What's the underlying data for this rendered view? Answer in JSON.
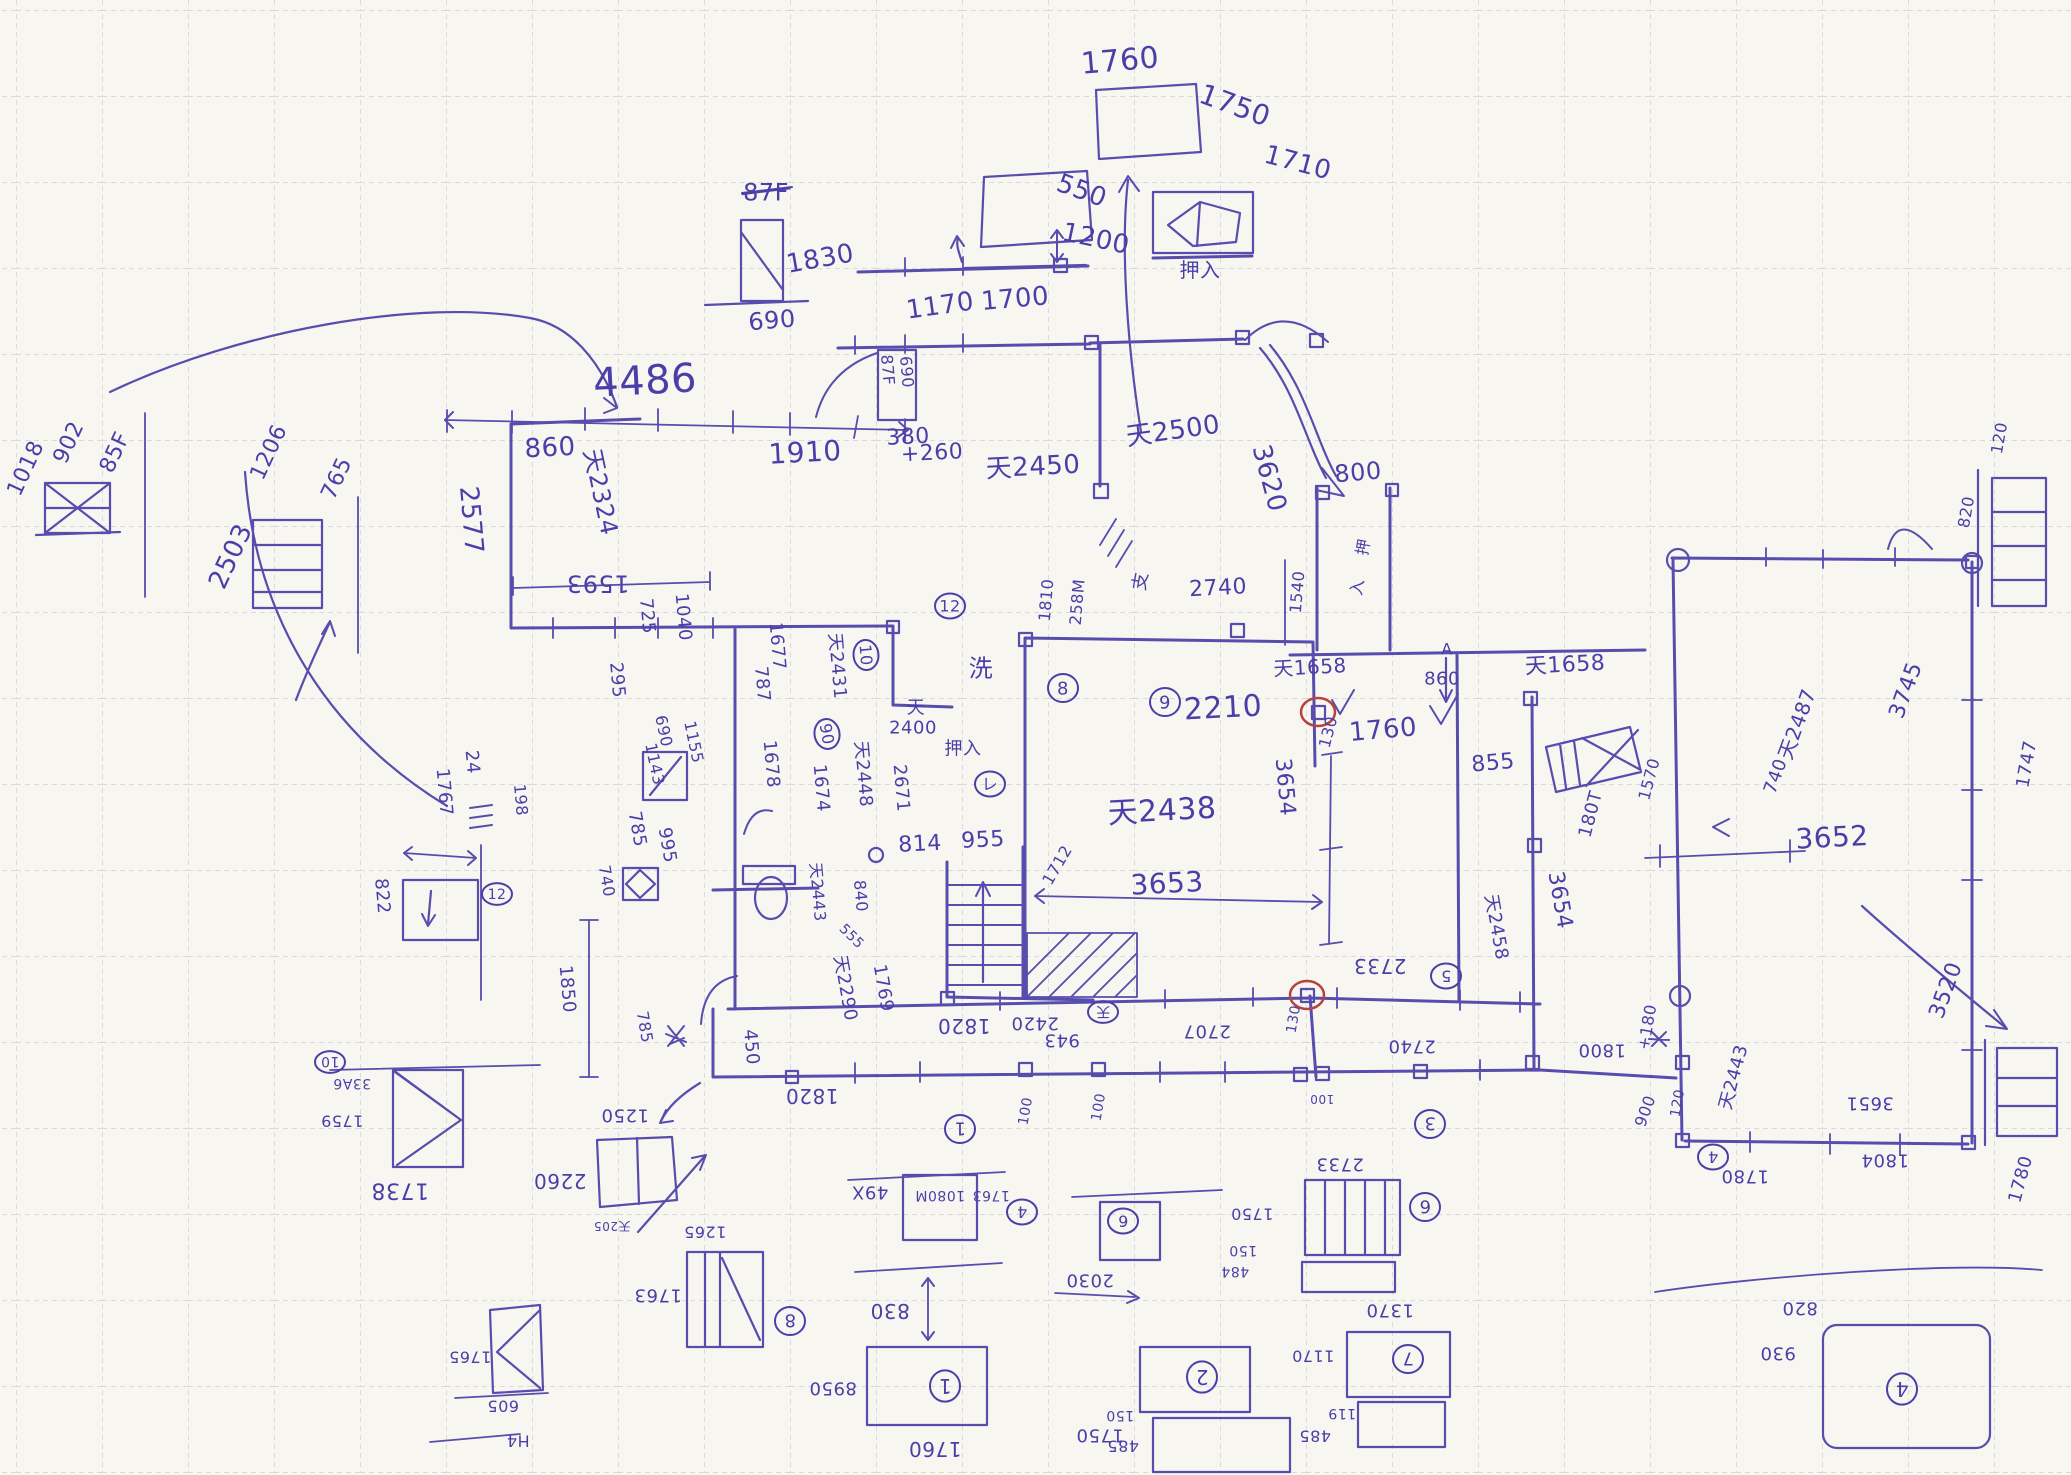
{
  "colors": {
    "paper": "#f8f6f1",
    "grid": "#c6c8d3",
    "primary": "#4a3fa8",
    "red": "#b5443c"
  },
  "annotations": [
    {
      "t": "1760",
      "x": 1120,
      "y": 60,
      "r": -5,
      "s": 30
    },
    {
      "t": "1750",
      "x": 1235,
      "y": 105,
      "r": 20,
      "s": 28
    },
    {
      "t": "550",
      "x": 1082,
      "y": 190,
      "r": 20,
      "s": 26
    },
    {
      "t": "1200",
      "x": 1096,
      "y": 238,
      "r": 12,
      "s": 26
    },
    {
      "t": "1170",
      "x": 940,
      "y": 305,
      "r": -8,
      "s": 26
    },
    {
      "t": "1700",
      "x": 1015,
      "y": 298,
      "r": -5,
      "s": 26
    },
    {
      "t": "87F",
      "x": 766,
      "y": 192,
      "r": 0,
      "s": 24,
      "strike": true
    },
    {
      "t": "1830",
      "x": 820,
      "y": 258,
      "r": -10,
      "s": 26
    },
    {
      "t": "690",
      "x": 772,
      "y": 320,
      "r": -5,
      "s": 24
    },
    {
      "t": "1710",
      "x": 1298,
      "y": 162,
      "r": 15,
      "s": 26
    },
    {
      "t": "押入",
      "x": 1200,
      "y": 270,
      "r": 0,
      "s": 20
    },
    {
      "t": "4486",
      "x": 645,
      "y": 380,
      "r": -3,
      "s": 40
    },
    {
      "t": "860",
      "x": 550,
      "y": 447,
      "r": -3,
      "s": 26
    },
    {
      "t": "1910",
      "x": 805,
      "y": 452,
      "r": -3,
      "s": 28
    },
    {
      "t": "380",
      "x": 908,
      "y": 436,
      "r": -3,
      "s": 22
    },
    {
      "t": "+260",
      "x": 932,
      "y": 452,
      "r": -3,
      "s": 22
    },
    {
      "t": "87F",
      "x": 888,
      "y": 370,
      "r": 85,
      "s": 16
    },
    {
      "t": "690",
      "x": 907,
      "y": 372,
      "r": 85,
      "s": 16
    },
    {
      "t": "天2500",
      "x": 1173,
      "y": 430,
      "r": -8,
      "s": 26
    },
    {
      "t": "天2450",
      "x": 1033,
      "y": 466,
      "r": -3,
      "s": 26
    },
    {
      "t": "3620",
      "x": 1270,
      "y": 478,
      "r": 75,
      "s": 26
    },
    {
      "t": "800",
      "x": 1358,
      "y": 472,
      "r": -5,
      "s": 24
    },
    {
      "t": "902",
      "x": 68,
      "y": 442,
      "r": -65,
      "s": 22
    },
    {
      "t": "85F",
      "x": 114,
      "y": 452,
      "r": -65,
      "s": 22
    },
    {
      "t": "1018",
      "x": 25,
      "y": 468,
      "r": -65,
      "s": 22
    },
    {
      "t": "1206",
      "x": 268,
      "y": 452,
      "r": -65,
      "s": 22
    },
    {
      "t": "765",
      "x": 336,
      "y": 478,
      "r": -65,
      "s": 22
    },
    {
      "t": "2503",
      "x": 230,
      "y": 556,
      "r": -65,
      "s": 26
    },
    {
      "t": "2577",
      "x": 472,
      "y": 520,
      "r": 85,
      "s": 26
    },
    {
      "t": "天2324",
      "x": 601,
      "y": 492,
      "r": 78,
      "s": 24
    },
    {
      "t": "1593",
      "x": 598,
      "y": 584,
      "r": 180,
      "s": 24
    },
    {
      "t": "725",
      "x": 648,
      "y": 616,
      "r": 85,
      "s": 18
    },
    {
      "t": "1040",
      "x": 684,
      "y": 617,
      "r": 85,
      "s": 18
    },
    {
      "t": "295",
      "x": 618,
      "y": 680,
      "r": 85,
      "s": 18
    },
    {
      "t": "1677",
      "x": 778,
      "y": 646,
      "r": 85,
      "s": 18
    },
    {
      "t": "787",
      "x": 763,
      "y": 684,
      "r": 85,
      "s": 18
    },
    {
      "t": "天2431",
      "x": 838,
      "y": 666,
      "r": 85,
      "s": 18
    },
    {
      "t": "10",
      "x": 866,
      "y": 655,
      "r": 85,
      "s": 16,
      "circ": true
    },
    {
      "t": "12",
      "x": 950,
      "y": 606,
      "r": 0,
      "s": 16,
      "circ": true
    },
    {
      "t": "洗",
      "x": 981,
      "y": 668,
      "r": 0,
      "s": 24
    },
    {
      "t": "天",
      "x": 916,
      "y": 707,
      "r": 0,
      "s": 18
    },
    {
      "t": "2400",
      "x": 913,
      "y": 727,
      "r": 0,
      "s": 18
    },
    {
      "t": "押入",
      "x": 963,
      "y": 748,
      "r": 0,
      "s": 18
    },
    {
      "t": "レ",
      "x": 990,
      "y": 784,
      "r": 0,
      "s": 16,
      "circ": true
    },
    {
      "t": "690",
      "x": 664,
      "y": 731,
      "r": 78,
      "s": 16
    },
    {
      "t": "1143",
      "x": 655,
      "y": 764,
      "r": 78,
      "s": 16
    },
    {
      "t": "1155",
      "x": 694,
      "y": 742,
      "r": 78,
      "s": 16
    },
    {
      "t": "1678",
      "x": 772,
      "y": 764,
      "r": 85,
      "s": 18
    },
    {
      "t": "1674",
      "x": 822,
      "y": 788,
      "r": 85,
      "s": 18
    },
    {
      "t": "天2448",
      "x": 864,
      "y": 774,
      "r": 85,
      "s": 18
    },
    {
      "t": "2671",
      "x": 902,
      "y": 788,
      "r": 85,
      "s": 18
    },
    {
      "t": "90",
      "x": 827,
      "y": 734,
      "r": 80,
      "s": 16,
      "circ": true
    },
    {
      "t": "995",
      "x": 668,
      "y": 845,
      "r": 80,
      "s": 18
    },
    {
      "t": "785",
      "x": 638,
      "y": 829,
      "r": 80,
      "s": 18
    },
    {
      "t": "740",
      "x": 607,
      "y": 881,
      "r": 80,
      "s": 16
    },
    {
      "t": "814",
      "x": 920,
      "y": 843,
      "r": -3,
      "s": 22
    },
    {
      "t": "955",
      "x": 983,
      "y": 839,
      "r": -3,
      "s": 22
    },
    {
      "t": "天2443",
      "x": 818,
      "y": 892,
      "r": 85,
      "s": 16
    },
    {
      "t": "840",
      "x": 861,
      "y": 896,
      "r": 85,
      "s": 16
    },
    {
      "t": "555",
      "x": 852,
      "y": 936,
      "r": 45,
      "s": 14
    },
    {
      "t": "天2290",
      "x": 846,
      "y": 988,
      "r": 80,
      "s": 18
    },
    {
      "t": "1769",
      "x": 884,
      "y": 988,
      "r": 80,
      "s": 18
    },
    {
      "t": "450",
      "x": 752,
      "y": 1047,
      "r": 85,
      "s": 18
    },
    {
      "t": "198",
      "x": 521,
      "y": 800,
      "r": 85,
      "s": 16
    },
    {
      "t": "1712",
      "x": 1057,
      "y": 865,
      "r": -60,
      "s": 16
    },
    {
      "t": "8",
      "x": 1063,
      "y": 688,
      "r": 0,
      "s": 18,
      "circ": true
    },
    {
      "t": "9",
      "x": 1165,
      "y": 702,
      "r": 0,
      "s": 18,
      "circ": true
    },
    {
      "t": "2210",
      "x": 1223,
      "y": 707,
      "r": -3,
      "s": 30
    },
    {
      "t": "130",
      "x": 1328,
      "y": 732,
      "r": -75,
      "s": 16
    },
    {
      "t": "1760",
      "x": 1383,
      "y": 729,
      "r": -5,
      "s": 26
    },
    {
      "t": "天1658",
      "x": 1310,
      "y": 667,
      "r": -3,
      "s": 20
    },
    {
      "t": "天1658",
      "x": 1565,
      "y": 664,
      "r": -3,
      "s": 22
    },
    {
      "t": "A",
      "x": 1447,
      "y": 649,
      "r": 0,
      "s": 16
    },
    {
      "t": "860",
      "x": 1442,
      "y": 678,
      "r": 0,
      "s": 18
    },
    {
      "t": "855",
      "x": 1493,
      "y": 762,
      "r": -5,
      "s": 22
    },
    {
      "t": "天2438",
      "x": 1162,
      "y": 810,
      "r": -3,
      "s": 30
    },
    {
      "t": "3654",
      "x": 1286,
      "y": 787,
      "r": 85,
      "s": 22
    },
    {
      "t": "3653",
      "x": 1167,
      "y": 883,
      "r": -3,
      "s": 28
    },
    {
      "t": "180T",
      "x": 1590,
      "y": 814,
      "r": -75,
      "s": 18
    },
    {
      "t": "1570",
      "x": 1649,
      "y": 779,
      "r": -75,
      "s": 16
    },
    {
      "t": "3654",
      "x": 1561,
      "y": 900,
      "r": 80,
      "s": 22
    },
    {
      "t": "天2458",
      "x": 1497,
      "y": 927,
      "r": 80,
      "s": 18
    },
    {
      "t": "天2487",
      "x": 1797,
      "y": 724,
      "r": -70,
      "s": 20
    },
    {
      "t": "740",
      "x": 1775,
      "y": 776,
      "r": -70,
      "s": 18
    },
    {
      "t": "3745",
      "x": 1905,
      "y": 690,
      "r": -70,
      "s": 22
    },
    {
      "t": "1747",
      "x": 2026,
      "y": 764,
      "r": -80,
      "s": 18
    },
    {
      "t": "3652",
      "x": 1832,
      "y": 837,
      "r": -3,
      "s": 28
    },
    {
      "t": "3520",
      "x": 1945,
      "y": 990,
      "r": -70,
      "s": 22
    },
    {
      "t": "120",
      "x": 1999,
      "y": 438,
      "r": -80,
      "s": 16
    },
    {
      "t": "820",
      "x": 1966,
      "y": 512,
      "r": -80,
      "s": 16
    },
    {
      "t": "1810",
      "x": 1046,
      "y": 600,
      "r": -85,
      "s": 16
    },
    {
      "t": "258M",
      "x": 1077,
      "y": 602,
      "r": -85,
      "s": 16
    },
    {
      "t": "支",
      "x": 1140,
      "y": 581,
      "r": -80,
      "s": 18
    },
    {
      "t": "2740",
      "x": 1218,
      "y": 587,
      "r": -3,
      "s": 22
    },
    {
      "t": "1540",
      "x": 1297,
      "y": 592,
      "r": -85,
      "s": 16
    },
    {
      "t": "押",
      "x": 1363,
      "y": 547,
      "r": -80,
      "s": 16
    },
    {
      "t": "入",
      "x": 1357,
      "y": 587,
      "r": -80,
      "s": 16
    },
    {
      "t": "1850",
      "x": 568,
      "y": 989,
      "r": 85,
      "s": 18
    },
    {
      "t": "785",
      "x": 645,
      "y": 1027,
      "r": 80,
      "s": 16
    },
    {
      "t": "1820",
      "x": 964,
      "y": 1026,
      "r": 180,
      "s": 20
    },
    {
      "t": "2420",
      "x": 1035,
      "y": 1024,
      "r": 180,
      "s": 18
    },
    {
      "t": "天",
      "x": 1103,
      "y": 1012,
      "r": 180,
      "s": 14,
      "circ": true
    },
    {
      "t": "943",
      "x": 1062,
      "y": 1041,
      "r": 180,
      "s": 18
    },
    {
      "t": "2707",
      "x": 1207,
      "y": 1032,
      "r": 180,
      "s": 18
    },
    {
      "t": "130",
      "x": 1293,
      "y": 1019,
      "r": -80,
      "s": 14
    },
    {
      "t": "2733",
      "x": 1380,
      "y": 966,
      "r": 180,
      "s": 20
    },
    {
      "t": "5",
      "x": 1446,
      "y": 976,
      "r": 180,
      "s": 16,
      "circ": true
    },
    {
      "t": "2740",
      "x": 1412,
      "y": 1047,
      "r": 180,
      "s": 18
    },
    {
      "t": "100",
      "x": 1025,
      "y": 1111,
      "r": -80,
      "s": 14
    },
    {
      "t": "100",
      "x": 1098,
      "y": 1107,
      "r": -80,
      "s": 14
    },
    {
      "t": "100",
      "x": 1322,
      "y": 1099,
      "r": 180,
      "s": 12
    },
    {
      "t": "1",
      "x": 960,
      "y": 1129,
      "r": 180,
      "s": 18,
      "circ": true
    },
    {
      "t": "3",
      "x": 1430,
      "y": 1124,
      "r": 180,
      "s": 18,
      "circ": true
    },
    {
      "t": "1820",
      "x": 812,
      "y": 1096,
      "r": 180,
      "s": 20
    },
    {
      "t": "1250",
      "x": 625,
      "y": 1116,
      "r": 180,
      "s": 18
    },
    {
      "t": "2260",
      "x": 560,
      "y": 1181,
      "r": 180,
      "s": 20
    },
    {
      "t": "天205",
      "x": 612,
      "y": 1226,
      "r": 180,
      "s": 12
    },
    {
      "t": "1265",
      "x": 705,
      "y": 1232,
      "r": 180,
      "s": 16
    },
    {
      "t": "1763",
      "x": 658,
      "y": 1296,
      "r": 180,
      "s": 18
    },
    {
      "t": "8",
      "x": 790,
      "y": 1321,
      "r": 180,
      "s": 18,
      "circ": true
    },
    {
      "t": "10",
      "x": 330,
      "y": 1062,
      "r": 180,
      "s": 14,
      "circ": true
    },
    {
      "t": "33A6",
      "x": 352,
      "y": 1084,
      "r": 180,
      "s": 14
    },
    {
      "t": "1759",
      "x": 342,
      "y": 1121,
      "r": 180,
      "s": 16
    },
    {
      "t": "1738",
      "x": 400,
      "y": 1191,
      "r": 180,
      "s": 22
    },
    {
      "t": "1767",
      "x": 445,
      "y": 792,
      "r": 85,
      "s": 18
    },
    {
      "t": "24",
      "x": 473,
      "y": 762,
      "r": 85,
      "s": 18
    },
    {
      "t": "822",
      "x": 383,
      "y": 896,
      "r": 85,
      "s": 18
    },
    {
      "t": "12",
      "x": 497,
      "y": 894,
      "r": 0,
      "s": 14,
      "circ": true
    },
    {
      "t": "1765",
      "x": 470,
      "y": 1357,
      "r": 180,
      "s": 16
    },
    {
      "t": "605",
      "x": 503,
      "y": 1406,
      "r": 180,
      "s": 16
    },
    {
      "t": "H4",
      "x": 518,
      "y": 1441,
      "r": 180,
      "s": 16
    },
    {
      "t": "49X",
      "x": 870,
      "y": 1193,
      "r": 180,
      "s": 18
    },
    {
      "t": "1080M",
      "x": 940,
      "y": 1196,
      "r": 180,
      "s": 14
    },
    {
      "t": "1763",
      "x": 991,
      "y": 1196,
      "r": 180,
      "s": 14
    },
    {
      "t": "4",
      "x": 1022,
      "y": 1212,
      "r": 180,
      "s": 16,
      "circ": true
    },
    {
      "t": "6",
      "x": 1123,
      "y": 1221,
      "r": 180,
      "s": 16,
      "circ": true
    },
    {
      "t": "2030",
      "x": 1090,
      "y": 1281,
      "r": 180,
      "s": 18
    },
    {
      "t": "830",
      "x": 890,
      "y": 1311,
      "r": 180,
      "s": 20
    },
    {
      "t": "1",
      "x": 945,
      "y": 1386,
      "r": 180,
      "s": 20,
      "circ": true
    },
    {
      "t": "8950",
      "x": 833,
      "y": 1389,
      "r": 180,
      "s": 18
    },
    {
      "t": "1760",
      "x": 935,
      "y": 1449,
      "r": 180,
      "s": 20
    },
    {
      "t": "2",
      "x": 1202,
      "y": 1377,
      "r": 180,
      "s": 20,
      "circ": true
    },
    {
      "t": "1750",
      "x": 1100,
      "y": 1436,
      "r": 180,
      "s": 18
    },
    {
      "t": "150",
      "x": 1120,
      "y": 1416,
      "r": 180,
      "s": 14
    },
    {
      "t": "485",
      "x": 1123,
      "y": 1446,
      "r": 180,
      "s": 16
    },
    {
      "t": "2733",
      "x": 1340,
      "y": 1165,
      "r": 180,
      "s": 18
    },
    {
      "t": "6",
      "x": 1425,
      "y": 1207,
      "r": 180,
      "s": 18,
      "circ": true
    },
    {
      "t": "1750",
      "x": 1252,
      "y": 1214,
      "r": 180,
      "s": 16
    },
    {
      "t": "150",
      "x": 1243,
      "y": 1251,
      "r": 180,
      "s": 14
    },
    {
      "t": "484",
      "x": 1235,
      "y": 1272,
      "r": 180,
      "s": 14
    },
    {
      "t": "1370",
      "x": 1390,
      "y": 1311,
      "r": 180,
      "s": 18
    },
    {
      "t": "7",
      "x": 1408,
      "y": 1359,
      "r": 180,
      "s": 18,
      "circ": true
    },
    {
      "t": "1170",
      "x": 1313,
      "y": 1356,
      "r": 180,
      "s": 16
    },
    {
      "t": "119",
      "x": 1342,
      "y": 1414,
      "r": 180,
      "s": 14
    },
    {
      "t": "485",
      "x": 1315,
      "y": 1436,
      "r": 180,
      "s": 16
    },
    {
      "t": "820",
      "x": 1800,
      "y": 1309,
      "r": 180,
      "s": 18
    },
    {
      "t": "930",
      "x": 1778,
      "y": 1354,
      "r": 180,
      "s": 18
    },
    {
      "t": "4",
      "x": 1902,
      "y": 1389,
      "r": 180,
      "s": 20,
      "circ": true
    },
    {
      "t": "1800",
      "x": 1602,
      "y": 1051,
      "r": 180,
      "s": 18
    },
    {
      "t": "+180",
      "x": 1647,
      "y": 1027,
      "r": -80,
      "s": 16
    },
    {
      "t": "900",
      "x": 1645,
      "y": 1111,
      "r": -70,
      "s": 16
    },
    {
      "t": "120",
      "x": 1677,
      "y": 1103,
      "r": -80,
      "s": 14
    },
    {
      "t": "天2443",
      "x": 1733,
      "y": 1077,
      "r": -75,
      "s": 18
    },
    {
      "t": "3651",
      "x": 1870,
      "y": 1104,
      "r": 180,
      "s": 18
    },
    {
      "t": "1804",
      "x": 1885,
      "y": 1161,
      "r": 180,
      "s": 18
    },
    {
      "t": "4",
      "x": 1713,
      "y": 1157,
      "r": 180,
      "s": 16,
      "circ": true
    },
    {
      "t": "1780",
      "x": 1745,
      "y": 1177,
      "r": 180,
      "s": 18
    },
    {
      "t": "1780",
      "x": 2020,
      "y": 1179,
      "r": -75,
      "s": 18
    }
  ]
}
